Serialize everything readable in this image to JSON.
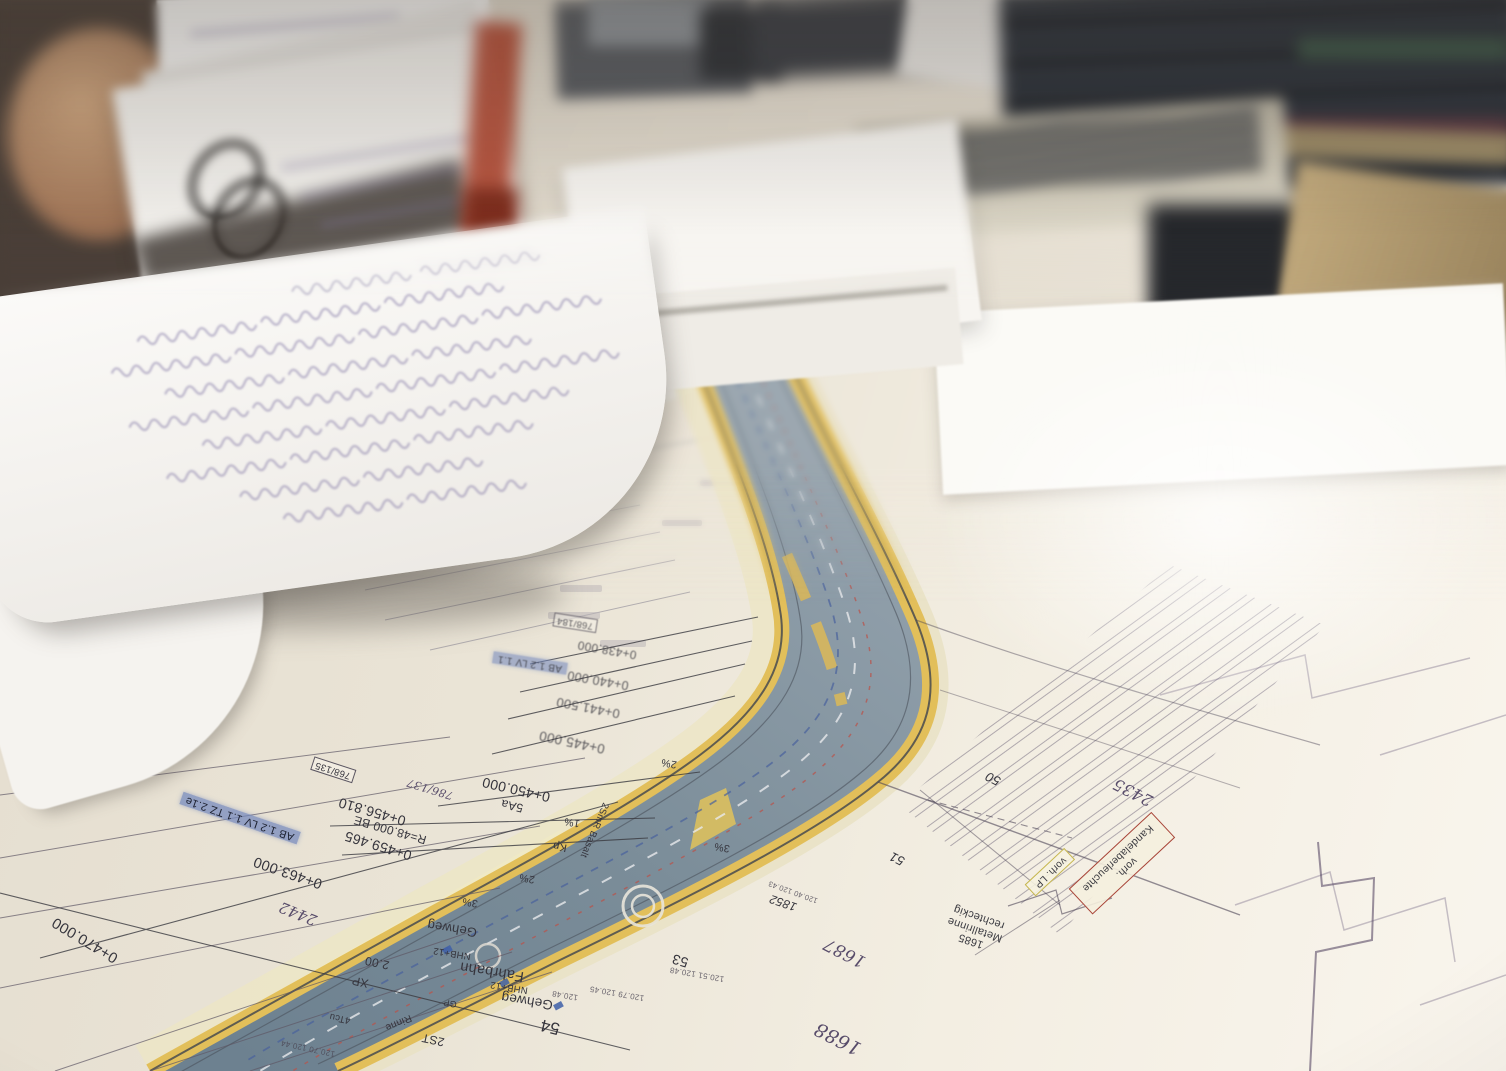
{
  "plan": {
    "stations": [
      {
        "text": "0+438.000"
      },
      {
        "text": "0+440.000"
      },
      {
        "text": "0+441.500"
      },
      {
        "text": "0+445.000"
      },
      {
        "text": "0+450.000"
      },
      {
        "text": "0+456.810"
      },
      {
        "text": "R=48.000 BE"
      },
      {
        "text": "0+459.465"
      },
      {
        "text": "0+463.000"
      },
      {
        "text": "0+470.000"
      }
    ],
    "bands": [
      {
        "text": "Gehweg"
      },
      {
        "text": "Fahrbahn"
      },
      {
        "text": "Gehweg"
      },
      {
        "text": "NHB+12"
      },
      {
        "text": "NHB+12"
      }
    ],
    "grades": [
      {
        "text": "1%"
      },
      {
        "text": "2%"
      },
      {
        "text": "2%"
      },
      {
        "text": "3%"
      },
      {
        "text": "3%"
      }
    ],
    "marks": [
      {
        "text": "5Aa"
      },
      {
        "text": "Kp"
      },
      {
        "text": "2SmR Basalt"
      },
      {
        "text": "XP"
      },
      {
        "text": "2.00"
      },
      {
        "text": "2ST"
      },
      {
        "text": "4Tcu"
      },
      {
        "text": "Rinne"
      },
      {
        "text": "GP"
      }
    ],
    "elevations": [
      {
        "text": "120.48"
      },
      {
        "text": "120.79 120.45"
      },
      {
        "text": "120.51 120.48"
      },
      {
        "text": "120.70 120.44"
      },
      {
        "text": "120.40 120.43"
      }
    ],
    "parcels": [
      {
        "text": "2435"
      },
      {
        "text": "2442"
      },
      {
        "text": "1687"
      },
      {
        "text": "1688"
      },
      {
        "text": "1852"
      },
      {
        "text": "786/137"
      },
      {
        "text": "768/135"
      },
      {
        "text": "768/184"
      }
    ],
    "points": [
      {
        "text": "50"
      },
      {
        "text": "51"
      },
      {
        "text": "53"
      },
      {
        "text": "54"
      }
    ],
    "annotations": {
      "kandelaber1": "vorh.",
      "kandelaber2": "Kandelaberleuchte",
      "lp": "vorh. LP",
      "rinne1": "1685",
      "rinne2": "Metallrinne",
      "rinne3": "rechteckig",
      "ab1": "AB 1.2 LV 1.1 TZ 2.1e",
      "ab2": "AB 1.2 LV 1.1",
      "breite": "weg Breite von 5.50m auf 2.8"
    },
    "colors": {
      "roadway": "#7f919c",
      "lane_yellow": "#e2bf5a",
      "sidewalk_cream": "#ece5c6",
      "paper": "#efe9dd",
      "highlight_blue": "#7286bc",
      "box_red": "#a84438",
      "box_yellow": "#c6b64e",
      "ink": "#35343c",
      "parcel_purple": "#584c6a"
    }
  }
}
